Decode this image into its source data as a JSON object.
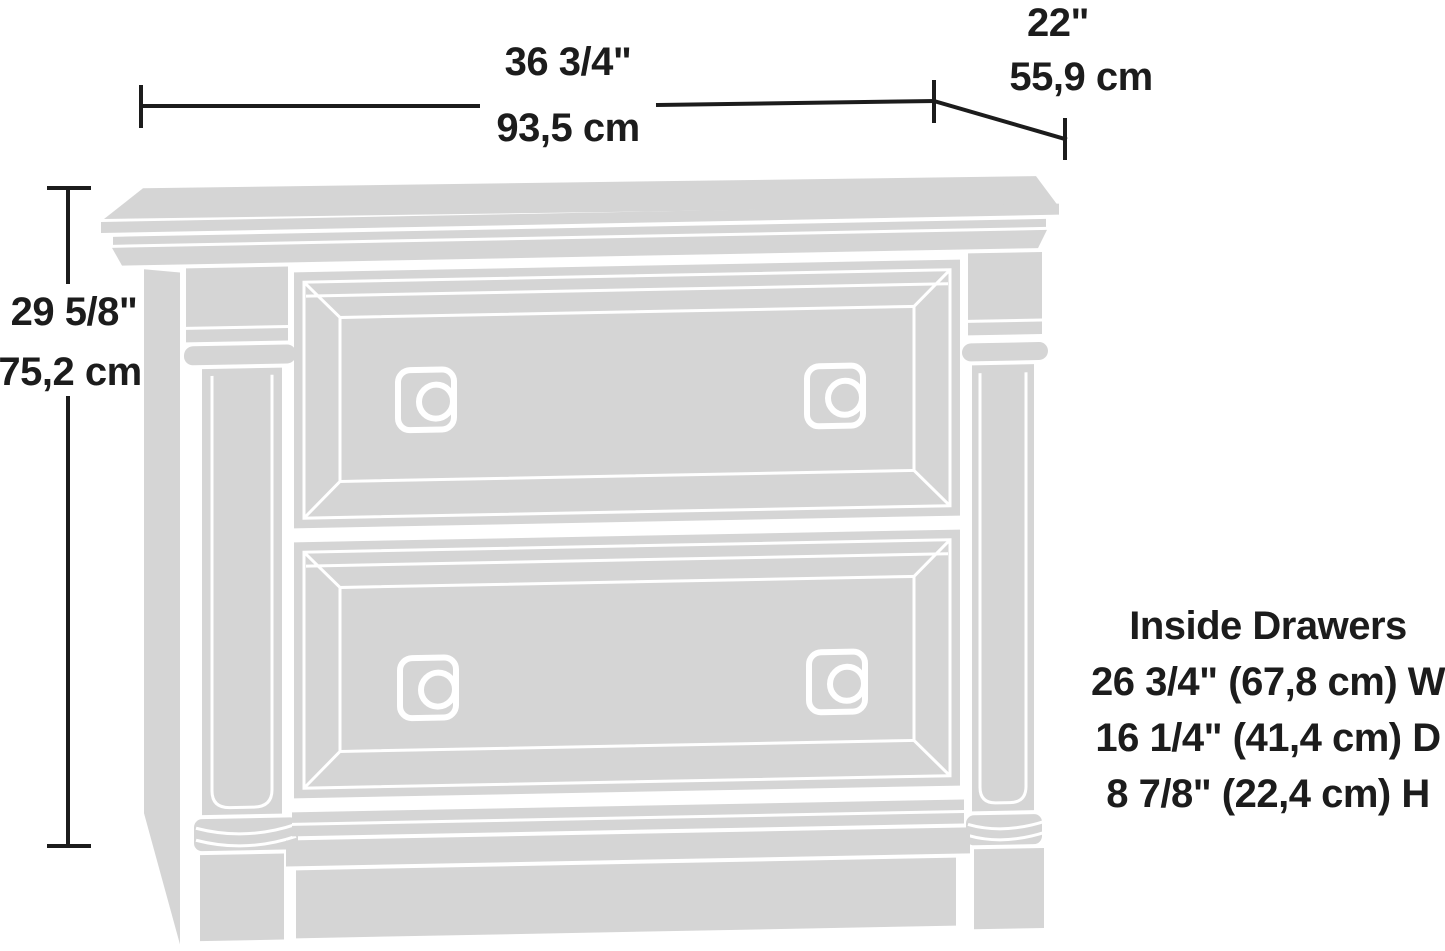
{
  "dimensions": {
    "width": {
      "imperial": "36 3/4\"",
      "metric": "93,5 cm"
    },
    "depth": {
      "imperial": "22\"",
      "metric": "55,9 cm"
    },
    "height": {
      "imperial": "29 5/8\"",
      "metric": "75,2 cm"
    }
  },
  "inside_drawers": {
    "heading": "Inside Drawers",
    "lines": [
      "26 3/4\" (67,8 cm) W",
      "16 1/4\" (41,4 cm) D",
      "8 7/8\" (22,4 cm) H"
    ]
  },
  "figure": {
    "subject": "two-drawer-lateral-file-cabinet",
    "fill_color": "#d5d5d5",
    "line_color": "#1c1c1c",
    "background": "#ffffff"
  }
}
